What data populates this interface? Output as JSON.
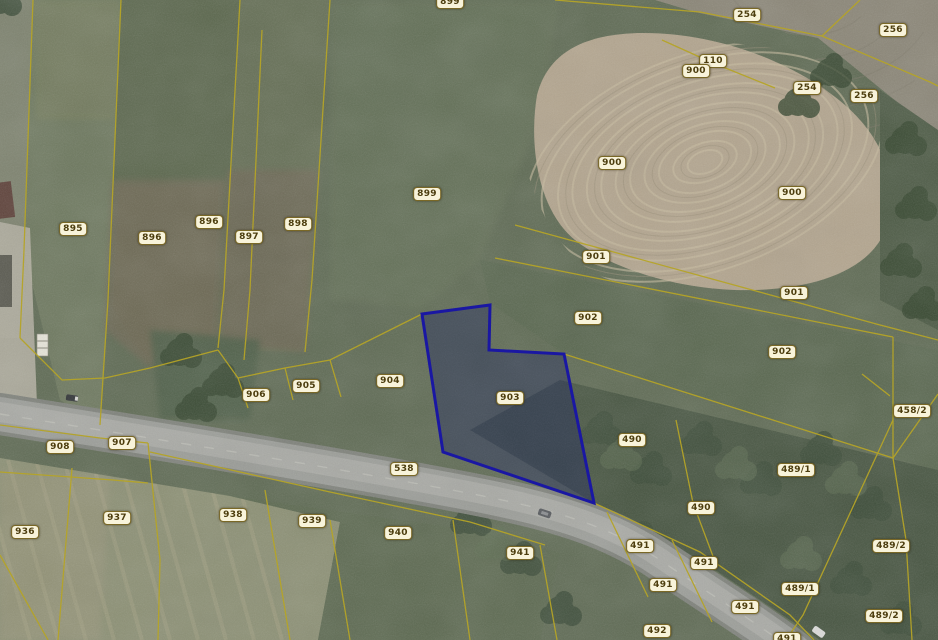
{
  "map": {
    "view_name": "cadastral-orthophoto-view",
    "colors": {
      "parcel_boundary": "#b5a427",
      "selected_parcel_outline": "#1a17a3",
      "label_background": "#f8f3da",
      "label_border": "#7a6826",
      "label_text": "#4c3d0e"
    },
    "selected_parcel_id": "903",
    "parcels": [
      {
        "id": "899",
        "x": 450,
        "y": 2
      },
      {
        "id": "254",
        "x": 747,
        "y": 15
      },
      {
        "id": "256",
        "x": 893,
        "y": 30
      },
      {
        "id": "110",
        "x": 713,
        "y": 61
      },
      {
        "id": "900",
        "x": 696,
        "y": 71
      },
      {
        "id": "254",
        "x": 807,
        "y": 88
      },
      {
        "id": "256",
        "x": 864,
        "y": 96
      },
      {
        "id": "900",
        "x": 612,
        "y": 163
      },
      {
        "id": "900",
        "x": 792,
        "y": 193
      },
      {
        "id": "899",
        "x": 427,
        "y": 194
      },
      {
        "id": "896",
        "x": 209,
        "y": 222
      },
      {
        "id": "898",
        "x": 298,
        "y": 224
      },
      {
        "id": "895",
        "x": 73,
        "y": 229
      },
      {
        "id": "896",
        "x": 152,
        "y": 238
      },
      {
        "id": "897",
        "x": 249,
        "y": 237
      },
      {
        "id": "901",
        "x": 596,
        "y": 257
      },
      {
        "id": "901",
        "x": 794,
        "y": 293
      },
      {
        "id": "902",
        "x": 588,
        "y": 318
      },
      {
        "id": "902",
        "x": 782,
        "y": 352
      },
      {
        "id": "904",
        "x": 390,
        "y": 381
      },
      {
        "id": "905",
        "x": 306,
        "y": 386
      },
      {
        "id": "906",
        "x": 256,
        "y": 395
      },
      {
        "id": "903",
        "x": 510,
        "y": 398,
        "selected": true
      },
      {
        "id": "458/2",
        "x": 912,
        "y": 411
      },
      {
        "id": "490",
        "x": 632,
        "y": 440
      },
      {
        "id": "907",
        "x": 122,
        "y": 443
      },
      {
        "id": "908",
        "x": 60,
        "y": 447
      },
      {
        "id": "538",
        "x": 404,
        "y": 469
      },
      {
        "id": "489/1",
        "x": 796,
        "y": 470
      },
      {
        "id": "490",
        "x": 701,
        "y": 508
      },
      {
        "id": "938",
        "x": 233,
        "y": 515
      },
      {
        "id": "937",
        "x": 117,
        "y": 518
      },
      {
        "id": "939",
        "x": 312,
        "y": 521
      },
      {
        "id": "936",
        "x": 25,
        "y": 532
      },
      {
        "id": "940",
        "x": 398,
        "y": 533
      },
      {
        "id": "491",
        "x": 640,
        "y": 546
      },
      {
        "id": "489/2",
        "x": 891,
        "y": 546
      },
      {
        "id": "941",
        "x": 520,
        "y": 553
      },
      {
        "id": "491",
        "x": 704,
        "y": 563
      },
      {
        "id": "491",
        "x": 663,
        "y": 585
      },
      {
        "id": "489/1",
        "x": 800,
        "y": 589
      },
      {
        "id": "491",
        "x": 745,
        "y": 607
      },
      {
        "id": "489/2",
        "x": 884,
        "y": 616
      },
      {
        "id": "492",
        "x": 657,
        "y": 631
      },
      {
        "id": "491",
        "x": 787,
        "y": 639
      }
    ]
  }
}
